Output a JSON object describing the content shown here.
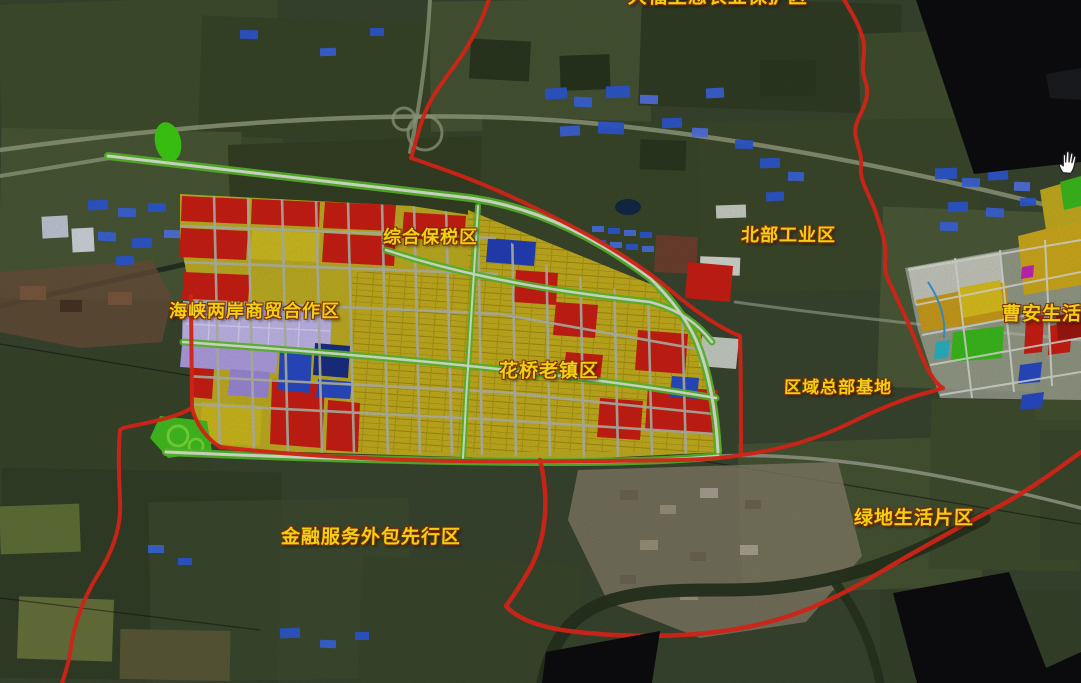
{
  "map": {
    "labels": [
      {
        "id": "dafu",
        "text": "大福生态农业保护区",
        "x": 628,
        "y": -13,
        "size": 19
      },
      {
        "id": "zonghe",
        "text": "综合保税区",
        "x": 383,
        "y": 228,
        "size": 18
      },
      {
        "id": "beibu",
        "text": "北部工业区",
        "x": 741,
        "y": 226,
        "size": 18
      },
      {
        "id": "haixia",
        "text": "海峡两岸商贸合作区",
        "x": 169,
        "y": 302,
        "size": 18
      },
      {
        "id": "huaqiao",
        "text": "花桥老镇区",
        "x": 499,
        "y": 361,
        "size": 19
      },
      {
        "id": "quyu",
        "text": "区域总部基地",
        "x": 784,
        "y": 379,
        "size": 17
      },
      {
        "id": "caoan",
        "text": "曹安生活区",
        "x": 1002,
        "y": 304,
        "size": 19
      },
      {
        "id": "jinrong",
        "text": "金融服务外包先行区",
        "x": 281,
        "y": 527,
        "size": 19
      },
      {
        "id": "lvdi",
        "text": "绿地生活片区",
        "x": 854,
        "y": 508,
        "size": 19
      }
    ],
    "cursor": {
      "icon": "hand-grab-cursor",
      "x": 1057,
      "y": 149
    },
    "colors": {
      "label_text": "#f0d015",
      "label_outline": "#7a2e00",
      "boundary_red": "#e8281a",
      "zone_red": "#cf1f14",
      "zone_dark_red": "#a01810",
      "zone_yellow": "#c9b623",
      "zone_gold": "#cfa01c",
      "zone_blue": "#2a4cc8",
      "zone_navy": "#1c2f86",
      "zone_purple": "#b3a2e6",
      "zone_lavender": "#c6bbf0",
      "zone_green": "#44c320",
      "road_light": "#b6bbac",
      "road_green_edge": "#5dc22e",
      "mask_black": "#0b0b0d",
      "water": "#27331f"
    }
  }
}
